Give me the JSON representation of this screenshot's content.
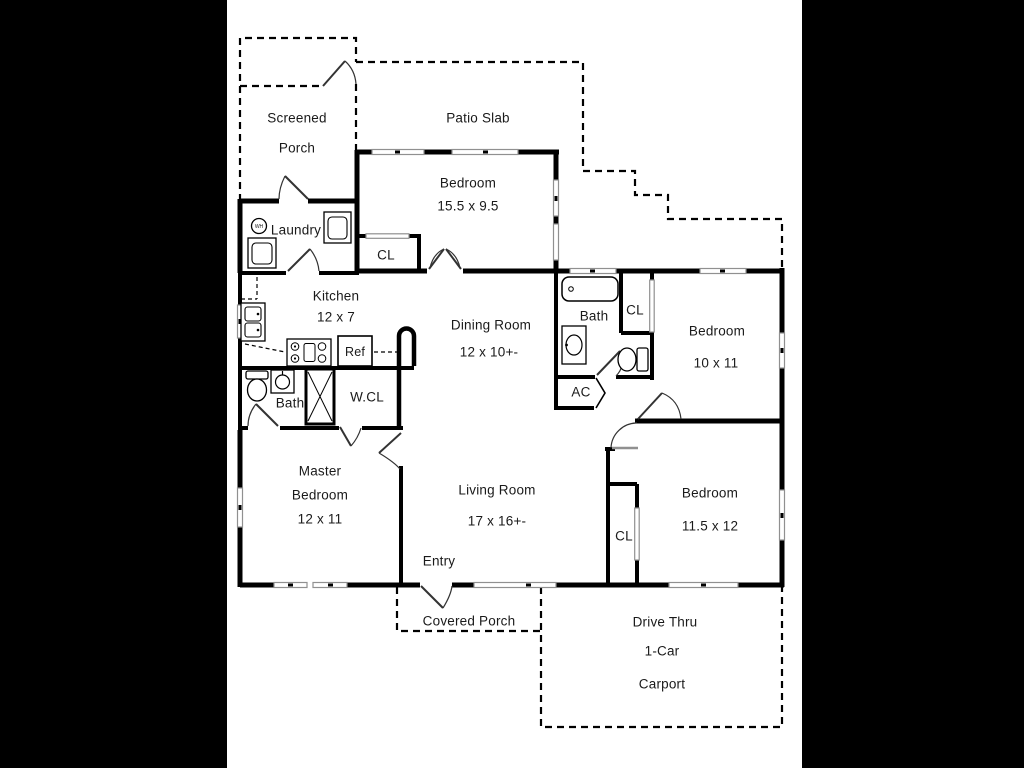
{
  "plan_type": "floor-plan",
  "colors": {
    "wall": "#000000",
    "window": "#909090",
    "door_arc": "#333333",
    "text": "#1a1a1a",
    "background": "#ffffff",
    "matte": "#000000"
  },
  "rooms": {
    "screened_porch": {
      "line1": "Screened",
      "line2": "Porch"
    },
    "patio_slab": {
      "name": "Patio Slab"
    },
    "bedroom_top": {
      "name": "Bedroom",
      "dims": "15.5 x 9.5"
    },
    "laundry": {
      "name": "Laundry",
      "water_heater": "WH"
    },
    "closet_kitchen": {
      "name": "CL"
    },
    "kitchen": {
      "name": "Kitchen",
      "dims": "12 x 7"
    },
    "dining_room": {
      "name": "Dining Room",
      "dims": "12 x 10+-"
    },
    "bath_right": {
      "name": "Bath"
    },
    "closet_bath_right": {
      "name": "CL"
    },
    "bedroom_right": {
      "name": "Bedroom",
      "dims": "10 x 11"
    },
    "refrigerator": {
      "name": "Ref"
    },
    "ac_closet": {
      "name": "AC"
    },
    "bath_left": {
      "name": "Bath"
    },
    "walkin_closet": {
      "name": "W.CL"
    },
    "master_bedroom": {
      "line1": "Master",
      "line2": "Bedroom",
      "dims": "12 x 11"
    },
    "living_room": {
      "name": "Living Room",
      "dims": "17 x 16+-"
    },
    "entry": {
      "name": "Entry"
    },
    "closet_bedroom_lower": {
      "name": "CL"
    },
    "bedroom_lower": {
      "name": "Bedroom",
      "dims": "11.5 x 12"
    },
    "covered_porch": {
      "name": "Covered Porch"
    },
    "carport": {
      "line1": "Drive Thru",
      "line2": "1-Car",
      "line3": "Carport"
    }
  }
}
